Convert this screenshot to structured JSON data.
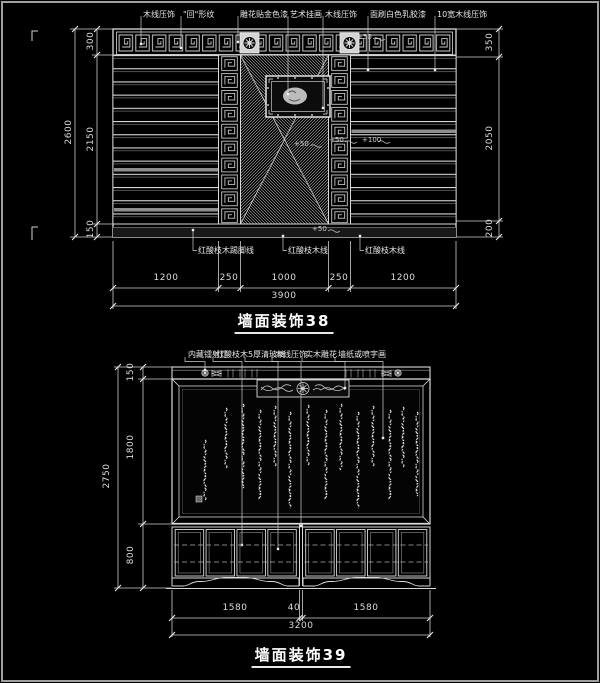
{
  "colors": {
    "background": "#000000",
    "line": "#d9d9d9",
    "bright": "#ffffff",
    "dim_text": "#dcdcdc",
    "viewport_border": "#9f9f9f"
  },
  "d38": {
    "title": "墙面装饰38",
    "top_labels": [
      "木线压饰",
      "\"回\"形纹",
      "雕花贴金色漆",
      "艺术挂画",
      "木线压饰",
      "面刷白色乳胶漆",
      "10宽木线压饰"
    ],
    "bottom_labels": [
      "红酸枝木踢脚线",
      "红酸枝木线",
      "红酸枝木线"
    ],
    "annotations": {
      "frieze": "+50",
      "center_a": "+50",
      "center_b": "+50",
      "right_band": "+100",
      "base": "+50"
    },
    "dims": {
      "left_overall": "2600",
      "left_top": "300",
      "left_mid": "2150",
      "left_bottom": "150",
      "right_top": "350",
      "right_mid": "2050",
      "right_bottom": "200",
      "bottom_segs": [
        "1200",
        "250",
        "1000",
        "250",
        "1200"
      ],
      "bottom_overall": "3900"
    }
  },
  "d39": {
    "title": "墙面装饰39",
    "top_labels": [
      "内藏镭射灯",
      "红酸枝木",
      "5厚清玻璃",
      "木线压饰",
      "实木雕花",
      "墙纸或喷字画"
    ],
    "dims": {
      "left_overall": "2750",
      "left_top": "150",
      "left_mid": "1800",
      "left_bottom": "800",
      "bottom_segs": [
        "1580",
        "40",
        "1580"
      ],
      "bottom_overall": "3200"
    }
  }
}
